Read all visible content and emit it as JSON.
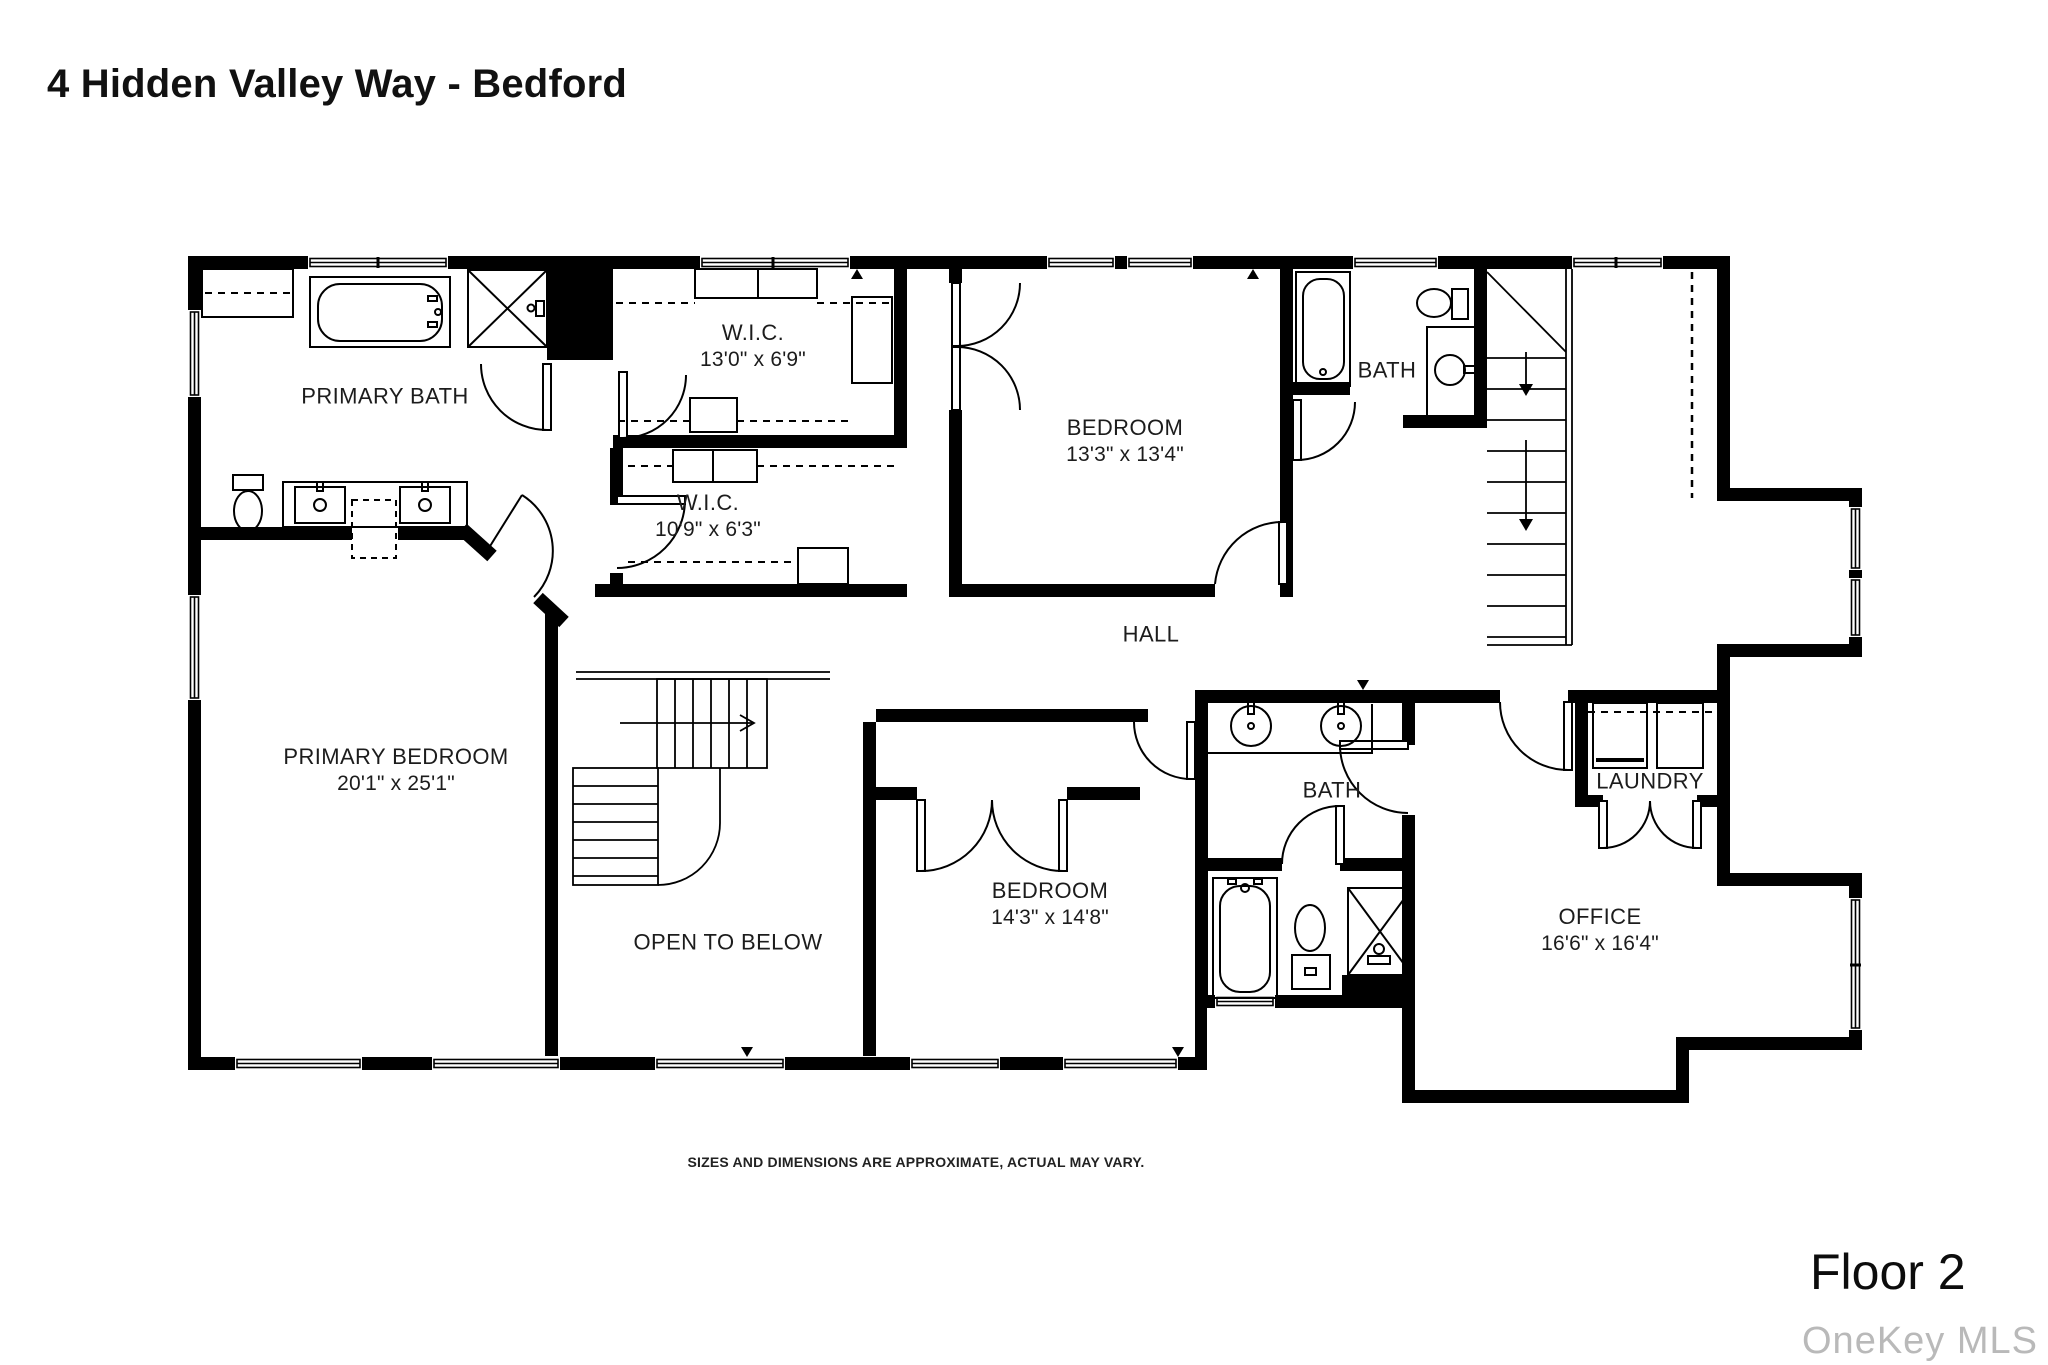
{
  "header": {
    "title": "4 Hidden Valley Way - Bedford"
  },
  "rooms": [
    {
      "id": "primary-bath",
      "name": "PRIMARY BATH",
      "dims": ""
    },
    {
      "id": "wic-upper",
      "name": "W.I.C.",
      "dims": "13'0\" x 6'9\""
    },
    {
      "id": "bedroom-upper",
      "name": "BEDROOM",
      "dims": "13'3\" x 13'4\""
    },
    {
      "id": "bath-upper",
      "name": "BATH",
      "dims": ""
    },
    {
      "id": "wic-lower",
      "name": "W.I.C.",
      "dims": "10'9\" x 6'3\""
    },
    {
      "id": "hall",
      "name": "HALL",
      "dims": ""
    },
    {
      "id": "primary-bedroom",
      "name": "PRIMARY BEDROOM",
      "dims": "20'1\" x 25'1\""
    },
    {
      "id": "open-to-below",
      "name": "OPEN TO BELOW",
      "dims": ""
    },
    {
      "id": "bedroom-lower",
      "name": "BEDROOM",
      "dims": "14'3\" x 14'8\""
    },
    {
      "id": "bath-lower",
      "name": "BATH",
      "dims": ""
    },
    {
      "id": "laundry",
      "name": "LAUNDRY",
      "dims": ""
    },
    {
      "id": "office",
      "name": "OFFICE",
      "dims": "16'6\" x 16'4\""
    }
  ],
  "footer": {
    "disclaimer": "SIZES AND DIMENSIONS ARE APPROXIMATE, ACTUAL MAY VARY.",
    "floor_label": "Floor 2",
    "watermark": "OneKey MLS"
  },
  "colors": {
    "wall": "#000000",
    "line": "#1a1a1a",
    "text": "#1c1c1c",
    "watermark": "#b9b9b9"
  }
}
